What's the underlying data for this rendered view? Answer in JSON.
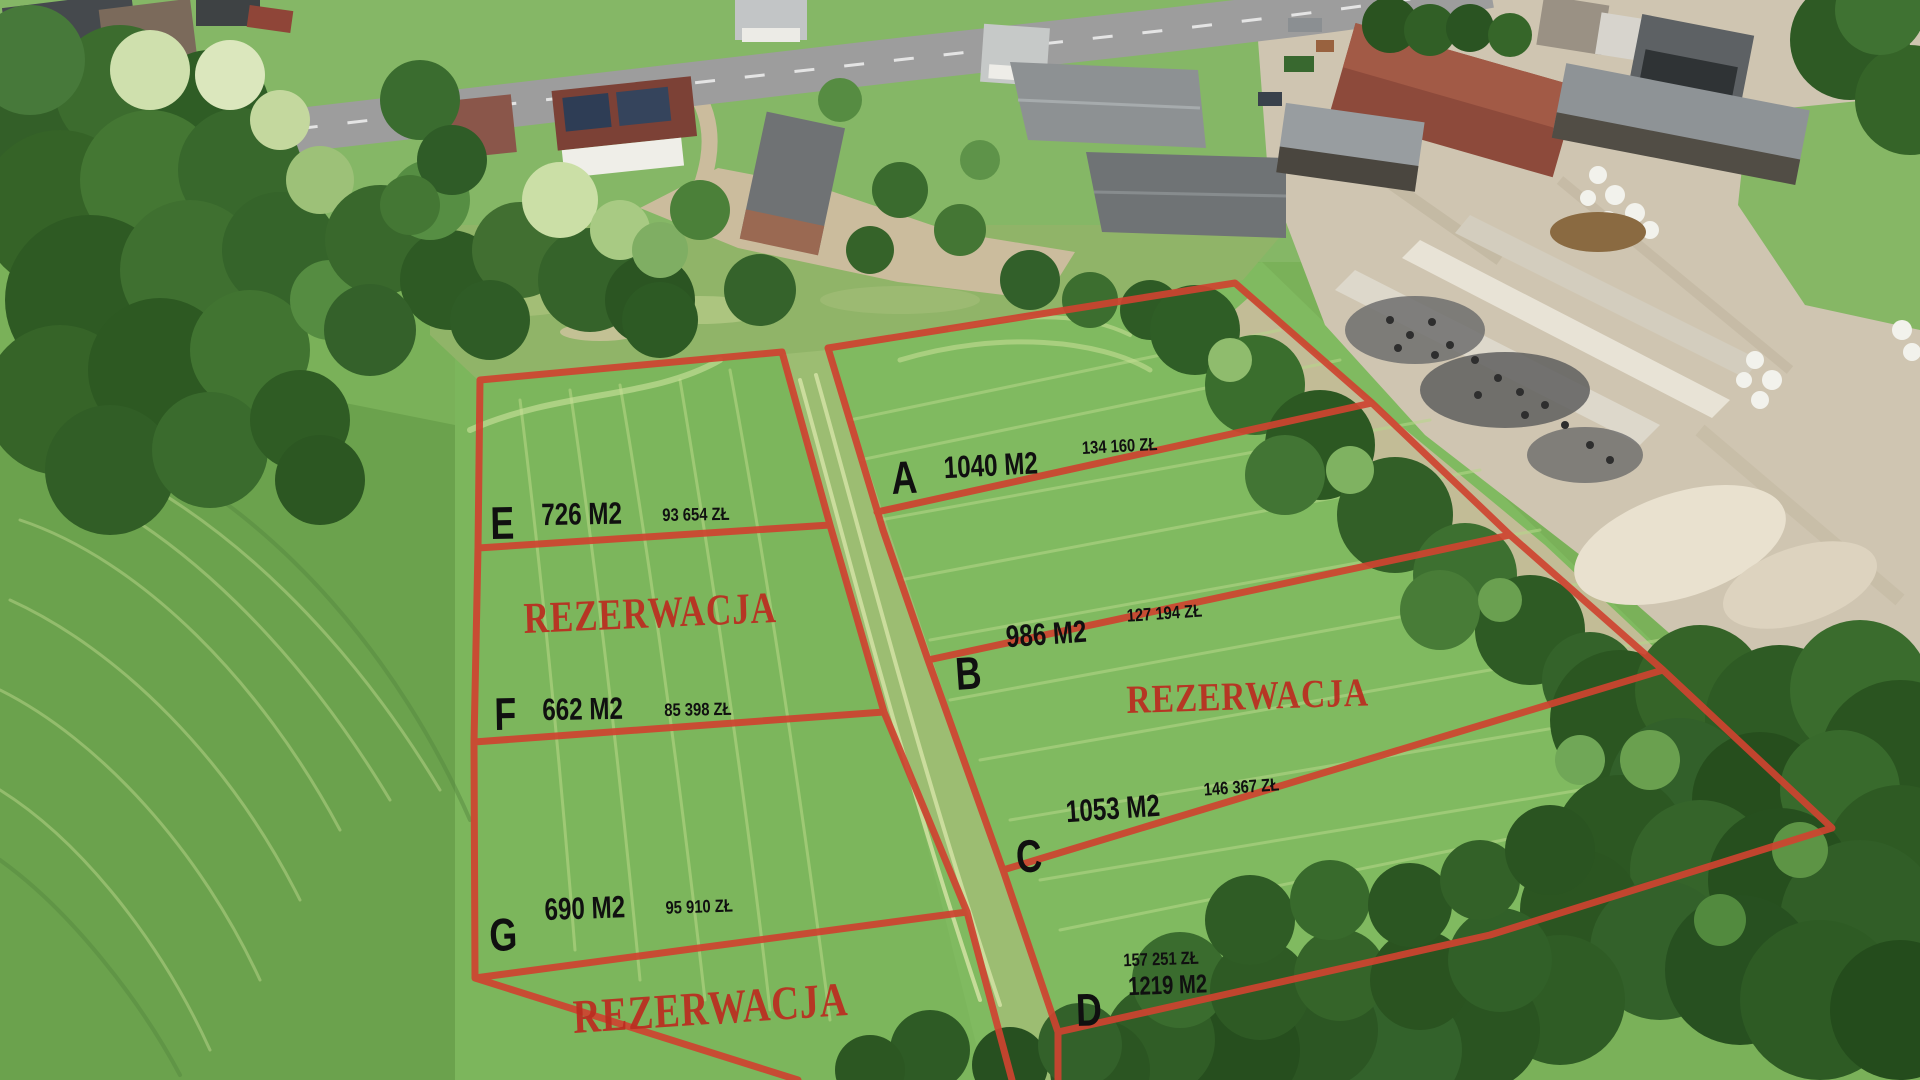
{
  "plots": [
    {
      "id": "A",
      "area": "1040 M2",
      "price": "134 160 ZŁ"
    },
    {
      "id": "B",
      "area": "986 M2",
      "price": "127 194 ZŁ"
    },
    {
      "id": "C",
      "area": "1053 M2",
      "price": "146 367 ZŁ"
    },
    {
      "id": "D",
      "area": "1219 M2",
      "price": "157 251 ZŁ"
    },
    {
      "id": "E",
      "area": "726 M2",
      "price": "93 654 ZŁ"
    },
    {
      "id": "F",
      "area": "662 M2",
      "price": "85 398 ZŁ"
    },
    {
      "id": "G",
      "area": "690 M2",
      "price": "95 910 ZŁ"
    }
  ],
  "reservations": [
    {
      "text": "REZERWACJA"
    },
    {
      "text": "REZERWACJA"
    },
    {
      "text": "REZERWACJA"
    }
  ],
  "colors": {
    "boundary_red": "#ce4330",
    "label_black": "#101010",
    "reservation_red": "#bb2d20"
  }
}
